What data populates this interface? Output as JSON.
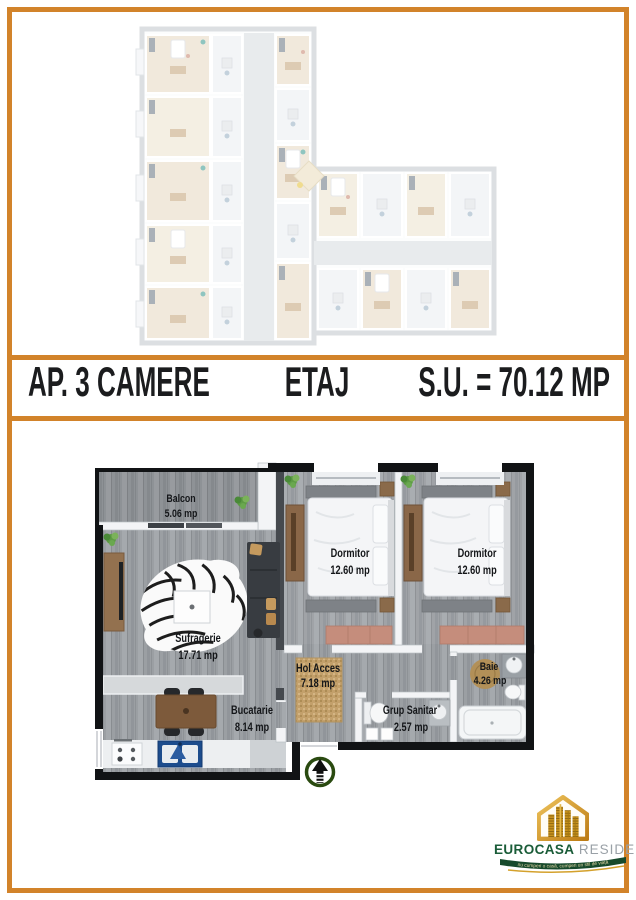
{
  "banner": {
    "left": "AP. 3 CAMERE",
    "center": "ETAJ",
    "right": "S.U. = 70.12 MP"
  },
  "plan": {
    "rooms": [
      {
        "id": "balcon",
        "name": "Balcon",
        "area": "5.06 mp"
      },
      {
        "id": "sufragerie",
        "name": "Sufragerie",
        "area": "17.71 mp"
      },
      {
        "id": "bucatarie",
        "name": "Bucatarie",
        "area": "8.14 mp"
      },
      {
        "id": "dormitor-1",
        "name": "Dormitor",
        "area": "12.60 mp"
      },
      {
        "id": "dormitor-2",
        "name": "Dormitor",
        "area": "12.60 mp"
      },
      {
        "id": "hol-acces",
        "name": "Hol Acces",
        "area": "7.18 mp"
      },
      {
        "id": "grup-sanitar",
        "name": "Grup Sanitar",
        "area": "2.57 mp"
      },
      {
        "id": "baie",
        "name": "Baie",
        "area": "4.26 mp"
      }
    ],
    "entrance_arrow_direction": "up"
  },
  "logo": {
    "brand": "EUROCASA",
    "brand2": "RESIDENCE",
    "tagline": "nu cumperi o casă, cumperi un stil de viață"
  },
  "colors": {
    "frame_orange": "#d2832a",
    "wall_black": "#111315",
    "floor_gray": "#9b9fa3",
    "arrow_green": "#2a4a10",
    "logo_green": "#1a5c38",
    "logo_gold": "#d4a12c",
    "rug_tan": "#c3a06b",
    "sink_blue": "#1c4c8d",
    "dresser_salmon": "#c58d7c"
  }
}
